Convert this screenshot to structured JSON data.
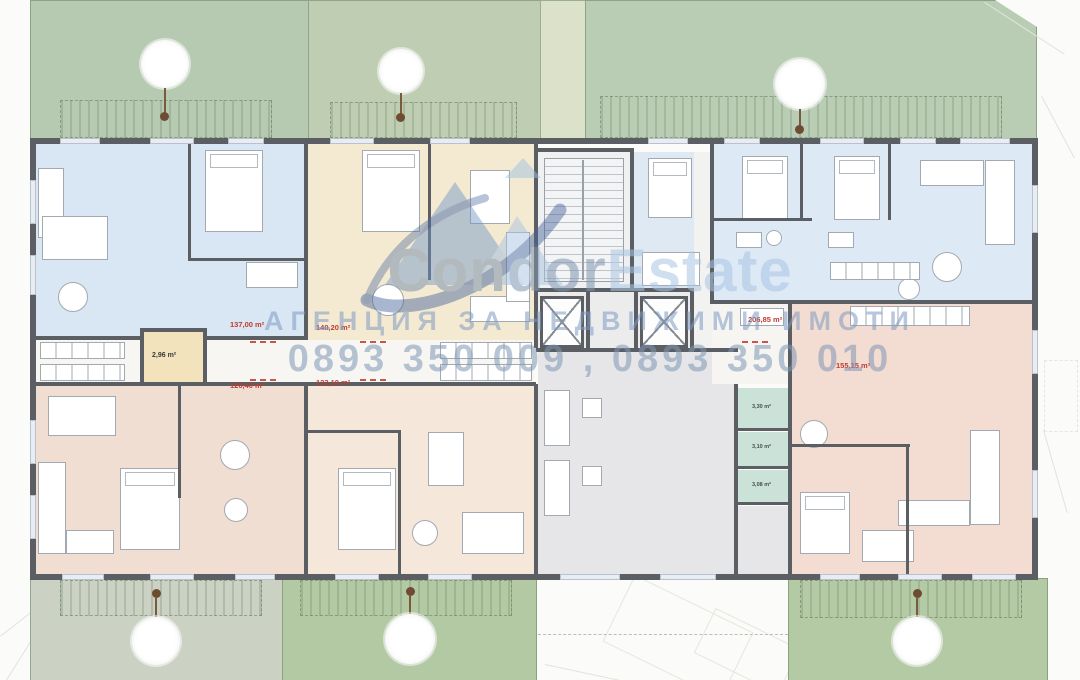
{
  "page": {
    "type": "apartment building floor plan with real-estate agency watermark"
  },
  "watermark": {
    "brand_primary": "Condor",
    "brand_secondary": "Estate",
    "subtitle": "АГЕНЦИЯ ЗА НЕДВИЖИМИ ИМОТИ",
    "phones": "0893 350 009 , 0893 350 010",
    "brand_primary_color": "#7e94af",
    "brand_secondary_color": "#a9c6e3",
    "logo_colors": [
      "#6e94c4",
      "#a7c3e1",
      "#45639a"
    ]
  },
  "apartments": [
    {
      "name": "top-left apartment",
      "area": "137,00 m²",
      "fill": "#d9e6f3"
    },
    {
      "name": "top-middle apartment",
      "area": "140,20 m²",
      "fill": "#f4ead2"
    },
    {
      "name": "top-right apartment",
      "area": "206,85 m²",
      "fill": "#dde9f5"
    },
    {
      "name": "bottom-left apartment",
      "area": "126,40 m²",
      "fill": "#f1ded2"
    },
    {
      "name": "bottom-middle apartment",
      "area": "123,10 m²",
      "fill": "#f5e7da"
    },
    {
      "name": "right apartment",
      "area": "155,15 m²",
      "fill": "#f3ddd2"
    }
  ],
  "small_rooms": [
    {
      "name": "lobby storage",
      "area": "2,96 m²",
      "fill": "#f2e3bd"
    },
    {
      "name": "storage 1",
      "area": "3,30 m²",
      "fill": "#cbe2d8"
    },
    {
      "name": "storage 2",
      "area": "3,10 m²",
      "fill": "#cbe2d8"
    },
    {
      "name": "storage 3",
      "area": "3,08 m²",
      "fill": "#cbe2d8"
    }
  ],
  "palette": {
    "wall": "#5b5f64",
    "garden_sage": "#b6c9b1",
    "garden_bright": "#b2c9a4",
    "garden_pale": "#cbd2c3",
    "hall_gray": "#e6e6e8",
    "area_label_red": "#c23b2e"
  }
}
